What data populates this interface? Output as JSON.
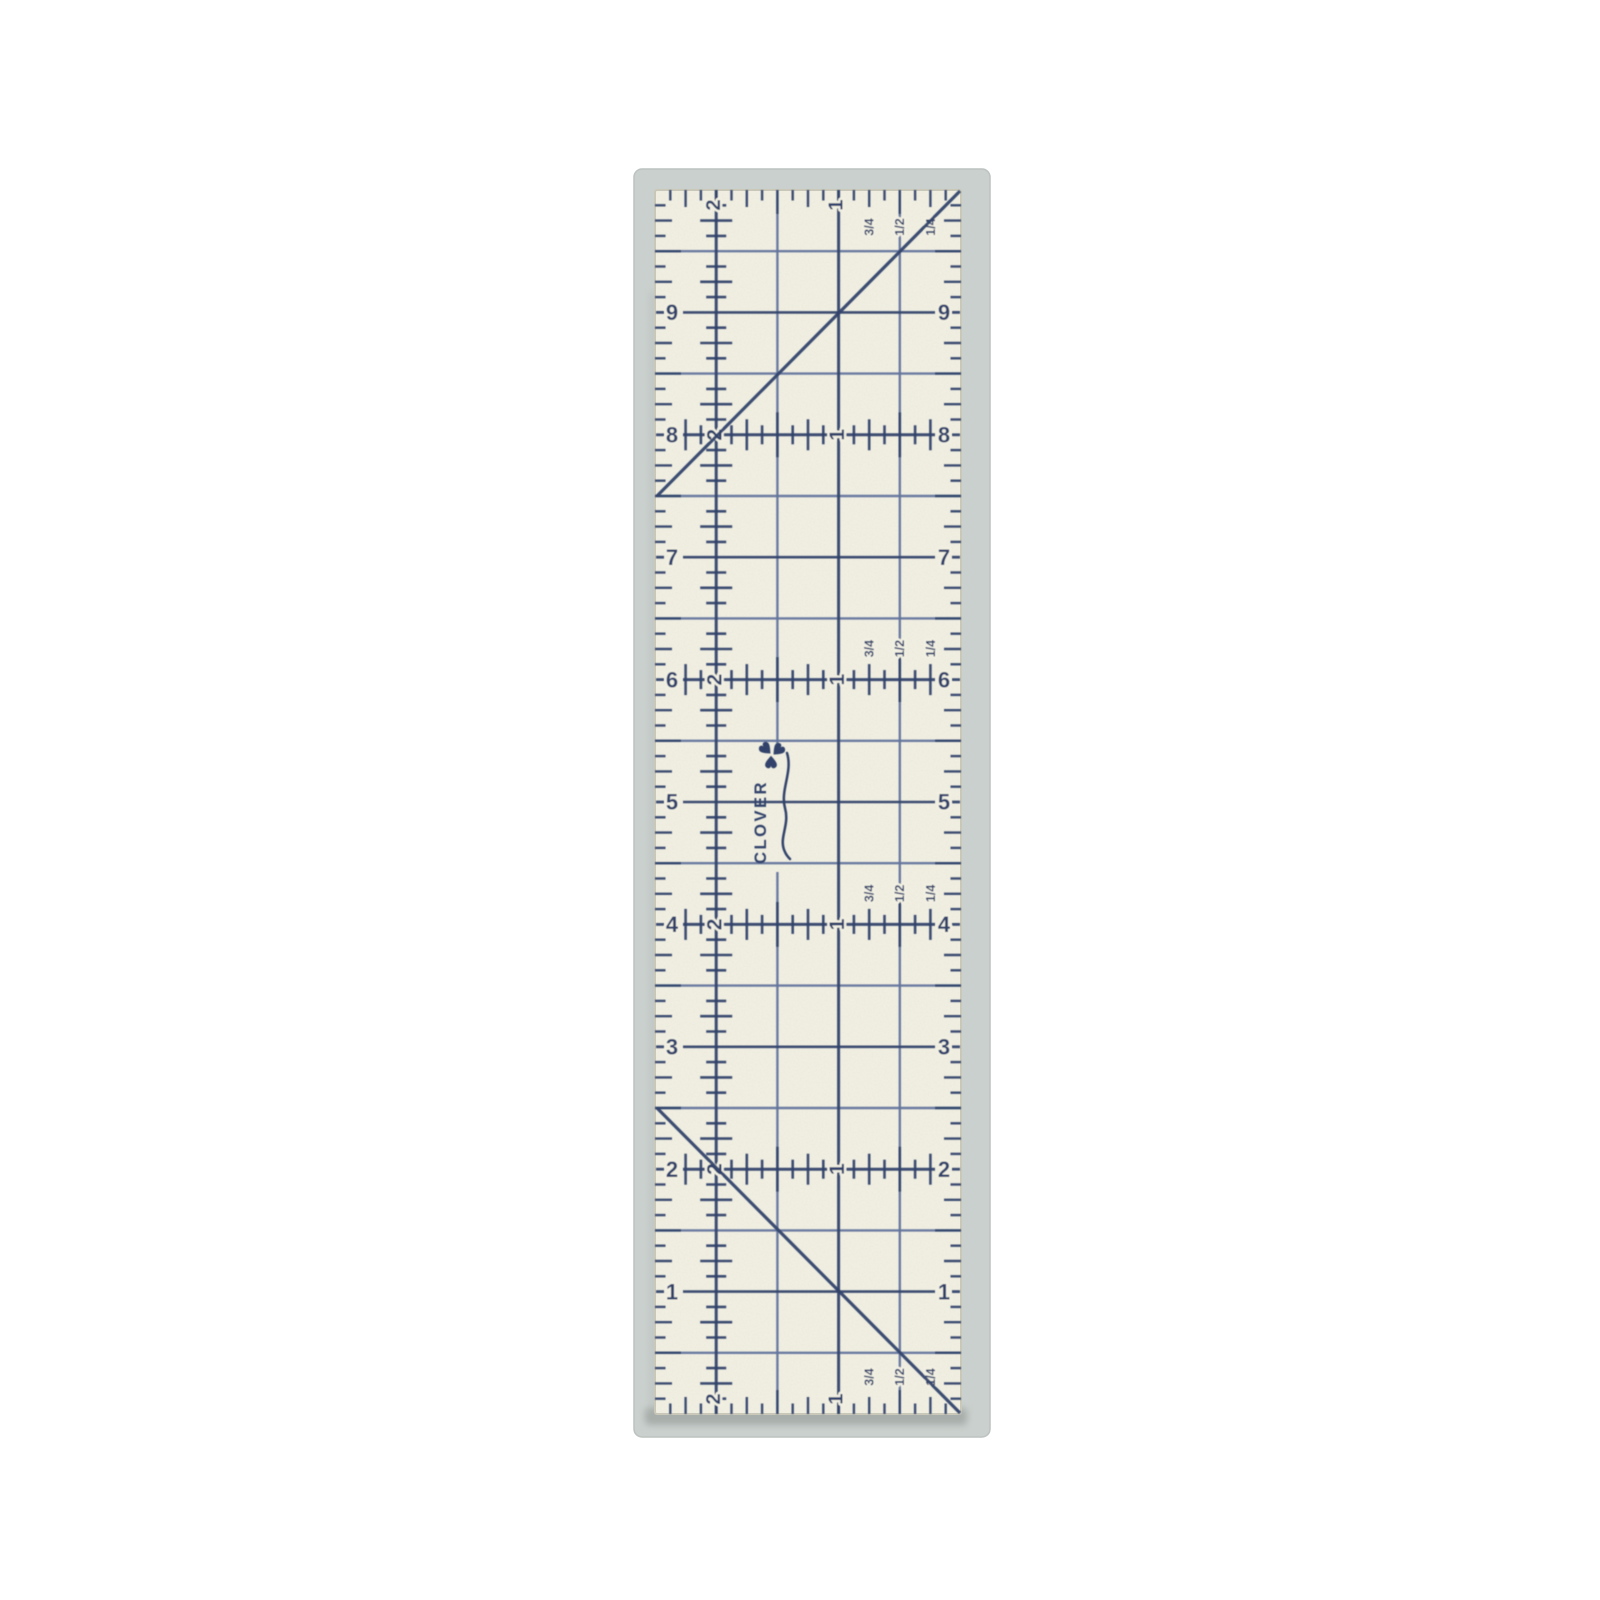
{
  "page": {
    "background_color": "#ffffff"
  },
  "mat": {
    "color": "#cad0cd",
    "edge_color": "#bcc2bf",
    "shadow_color": "#a7aeaa"
  },
  "ruler": {
    "surface_color": "#f2f0e3",
    "edge_color": "#c9c8b9",
    "ink_color": "#32436b",
    "ink_light_color": "#64759d",
    "length_inches": 10,
    "width_inches": 2.5,
    "left_edge_numbers": [
      "9",
      "8",
      "7",
      "6",
      "5",
      "4",
      "3",
      "2",
      "1"
    ],
    "right_edge_numbers": [
      "9",
      "8",
      "7",
      "6",
      "5",
      "4",
      "3",
      "2",
      "1"
    ],
    "inch_column_labels": [
      "2",
      "1"
    ],
    "fraction_labels": [
      "3/4",
      "1/2",
      "1/4"
    ],
    "crosshair_rows": [
      8,
      6,
      4,
      2
    ],
    "fraction_label_rows": [
      6,
      4
    ],
    "brand": {
      "name": "CLOVER"
    }
  }
}
